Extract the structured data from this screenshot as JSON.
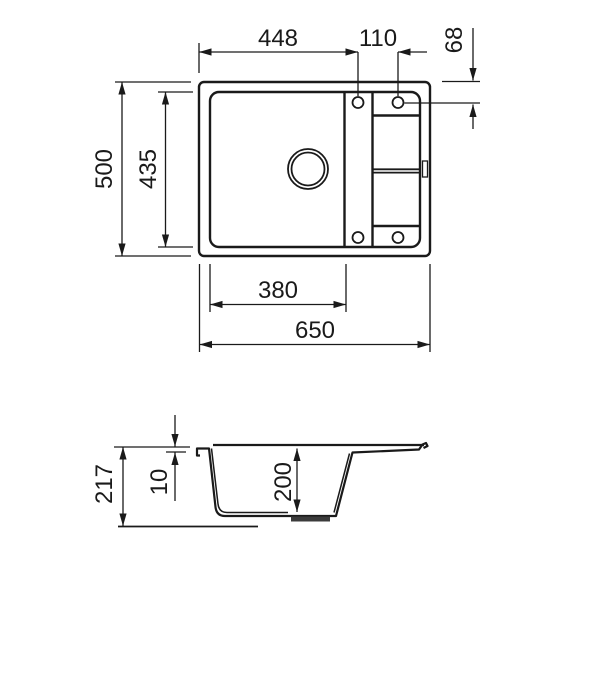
{
  "drawing": {
    "dims": {
      "top_width_to_hole": "448",
      "hole_spacing": "110",
      "hole_edge_offset": "68",
      "overall_depth": "500",
      "bowl_inner_depth": "435",
      "bowl_inner_width": "380",
      "overall_width": "650",
      "total_height": "217",
      "rim_thickness": "10",
      "bowl_depth": "200"
    },
    "colors": {
      "line": "#1a1a1a",
      "background": "#ffffff"
    }
  }
}
